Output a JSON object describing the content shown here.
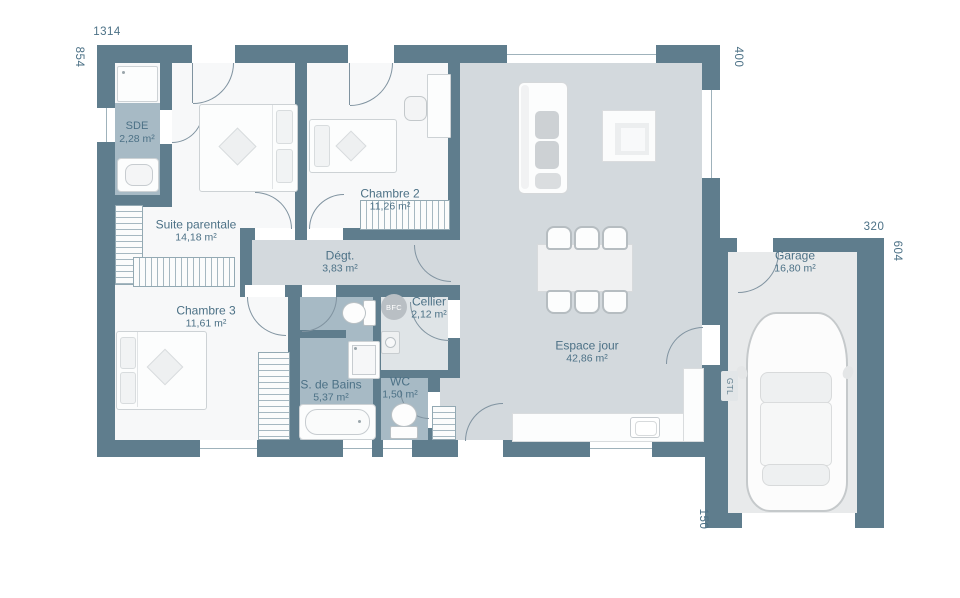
{
  "dimensions": {
    "top": "1314",
    "left": "854",
    "house_right": "400",
    "garage_top": "320",
    "garage_right": "604",
    "garage_bottom_left": "150"
  },
  "rooms": {
    "sde": {
      "name": "SDE",
      "area": "2,28 m²"
    },
    "suite_parentale": {
      "name": "Suite parentale",
      "area": "14,18 m²"
    },
    "chambre2": {
      "name": "Chambre 2",
      "area": "11,26 m²"
    },
    "chambre3": {
      "name": "Chambre 3",
      "area": "11,61 m²"
    },
    "degagement": {
      "name": "Dégt.",
      "area": "3,83 m²"
    },
    "cellier": {
      "name": "Cellier",
      "area": "2,12 m²"
    },
    "salle_de_bains": {
      "name": "S. de Bains",
      "area": "5,37 m²"
    },
    "wc": {
      "name": "WC",
      "area": "1,50 m²"
    },
    "espace_jour": {
      "name": "Espace jour",
      "area": "42,86 m²"
    },
    "garage": {
      "name": "Garage",
      "area": "16,80 m²"
    }
  },
  "annotations": {
    "bfc": "BFC",
    "gtl": "GTL"
  },
  "colors": {
    "wall": "#5f7d8d",
    "floor_room": "#f7f8f9",
    "floor_living": "#d3d9dd",
    "floor_wet": "#a7bac5",
    "floor_cellier": "#dfe4e7",
    "floor_garage": "#e8eaeb",
    "label_text": "#4c7186"
  }
}
